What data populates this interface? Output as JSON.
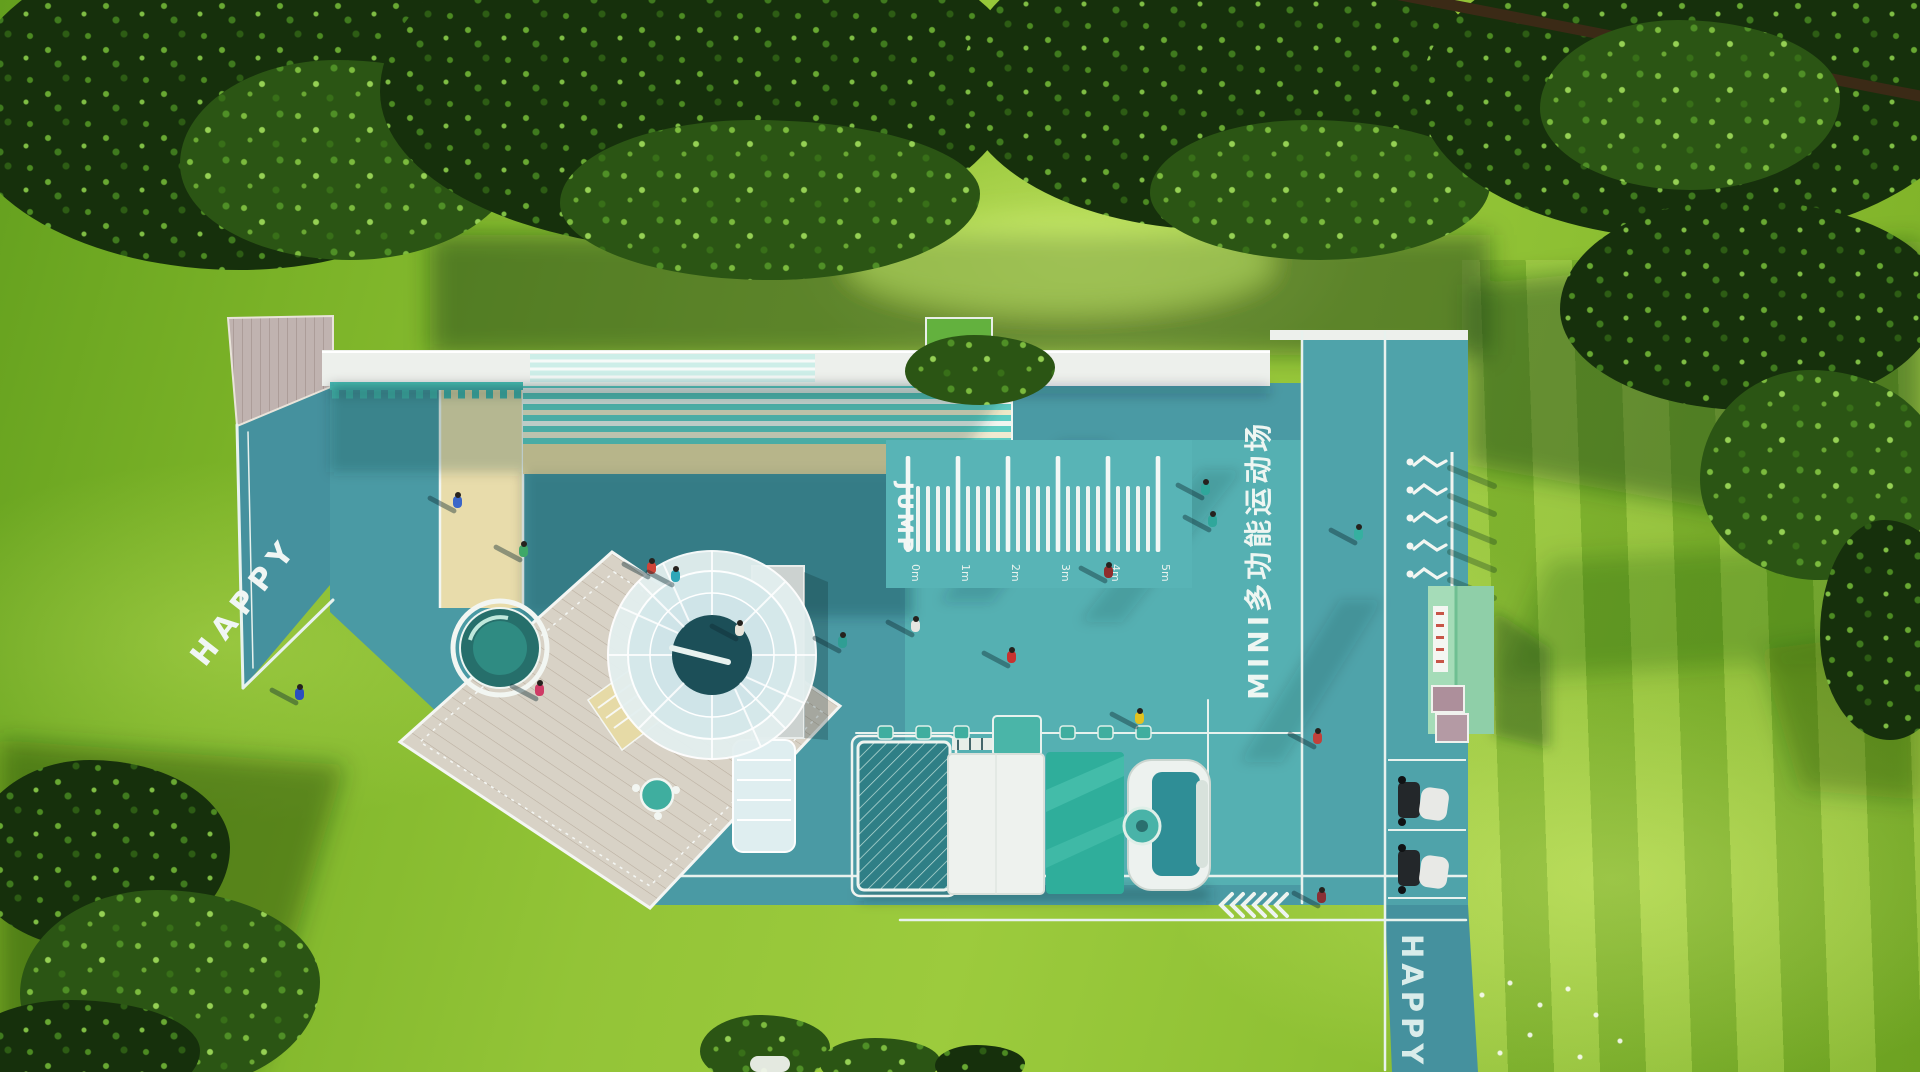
{
  "texts": {
    "happy_path_left": "HAPPY",
    "happy_path_right": "HAPPY",
    "jump_label": "JUMP",
    "court_title": "MINI多功能运动场"
  },
  "jump_ruler": {
    "labels": [
      "0m",
      "1m",
      "2m",
      "3m",
      "4m",
      "5m"
    ],
    "minor_ticks_between": 4
  },
  "sculptures": {
    "count": 5
  },
  "chevrons": {
    "count": 6
  },
  "colors": {
    "court_teal": "#4a9aa4",
    "court_teal_light": "#55b0b2",
    "lane_teal": "#45919e",
    "sand": "#e8dcab",
    "stripe_mint": "#5ecec4",
    "white": "#f2f6f2",
    "roof_white": "#edf0ec",
    "building_green": "#8fcfa8",
    "accent_mint": "#49b3a8",
    "grass_bright": "#9ccb3d",
    "foliage_dark": "#16300c"
  },
  "figures": [
    {
      "x": 458,
      "y": 500,
      "c": "#3a66c8"
    },
    {
      "x": 300,
      "y": 692,
      "c": "#2b4fc0"
    },
    {
      "x": 652,
      "y": 566,
      "c": "#cf4438"
    },
    {
      "x": 676,
      "y": 574,
      "c": "#2fa7b8"
    },
    {
      "x": 540,
      "y": 688,
      "c": "#cf3b66"
    },
    {
      "x": 524,
      "y": 549,
      "c": "#3fa868"
    },
    {
      "x": 843,
      "y": 640,
      "c": "#2f9e94"
    },
    {
      "x": 916,
      "y": 624,
      "c": "#e6e6e2"
    },
    {
      "x": 740,
      "y": 628,
      "c": "#e8e4da"
    },
    {
      "x": 1012,
      "y": 655,
      "c": "#c83230"
    },
    {
      "x": 1109,
      "y": 570,
      "c": "#8f2d2d"
    },
    {
      "x": 1206,
      "y": 487,
      "c": "#2fa79b"
    },
    {
      "x": 1213,
      "y": 519,
      "c": "#2fa79b"
    },
    {
      "x": 1359,
      "y": 532,
      "c": "#35b0a0"
    },
    {
      "x": 1318,
      "y": 736,
      "c": "#c2403a"
    },
    {
      "x": 1322,
      "y": 895,
      "c": "#8a2f35"
    },
    {
      "x": 1140,
      "y": 716,
      "c": "#e2c21f"
    }
  ]
}
